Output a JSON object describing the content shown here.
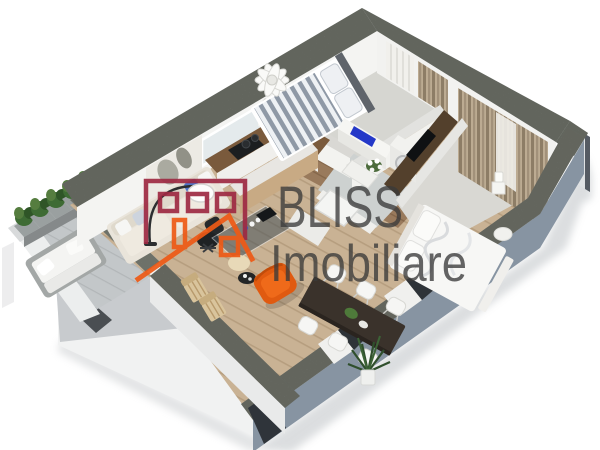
{
  "watermark": {
    "brand": "BLISS",
    "subtitle": "Imobiliare"
  },
  "palette": {
    "logo_maroon": "#9E2A43",
    "logo_orange": "#EE5A16",
    "watermark_text": "#3A3A3A",
    "wall_concrete_top": "#7B7F77",
    "wall_outer_face_blue": "#8794A2",
    "interior_wall_white": "#F2F2F0",
    "wood_floor": "#C9B294",
    "hall_wood_floor": "#997A5C",
    "balcony_floor": "#C3C7C9",
    "curtain_tan": "#A2917A",
    "armchair_orange": "#E05A10",
    "tv_blue": "#2438C8",
    "plant_green": "#3C6336"
  }
}
